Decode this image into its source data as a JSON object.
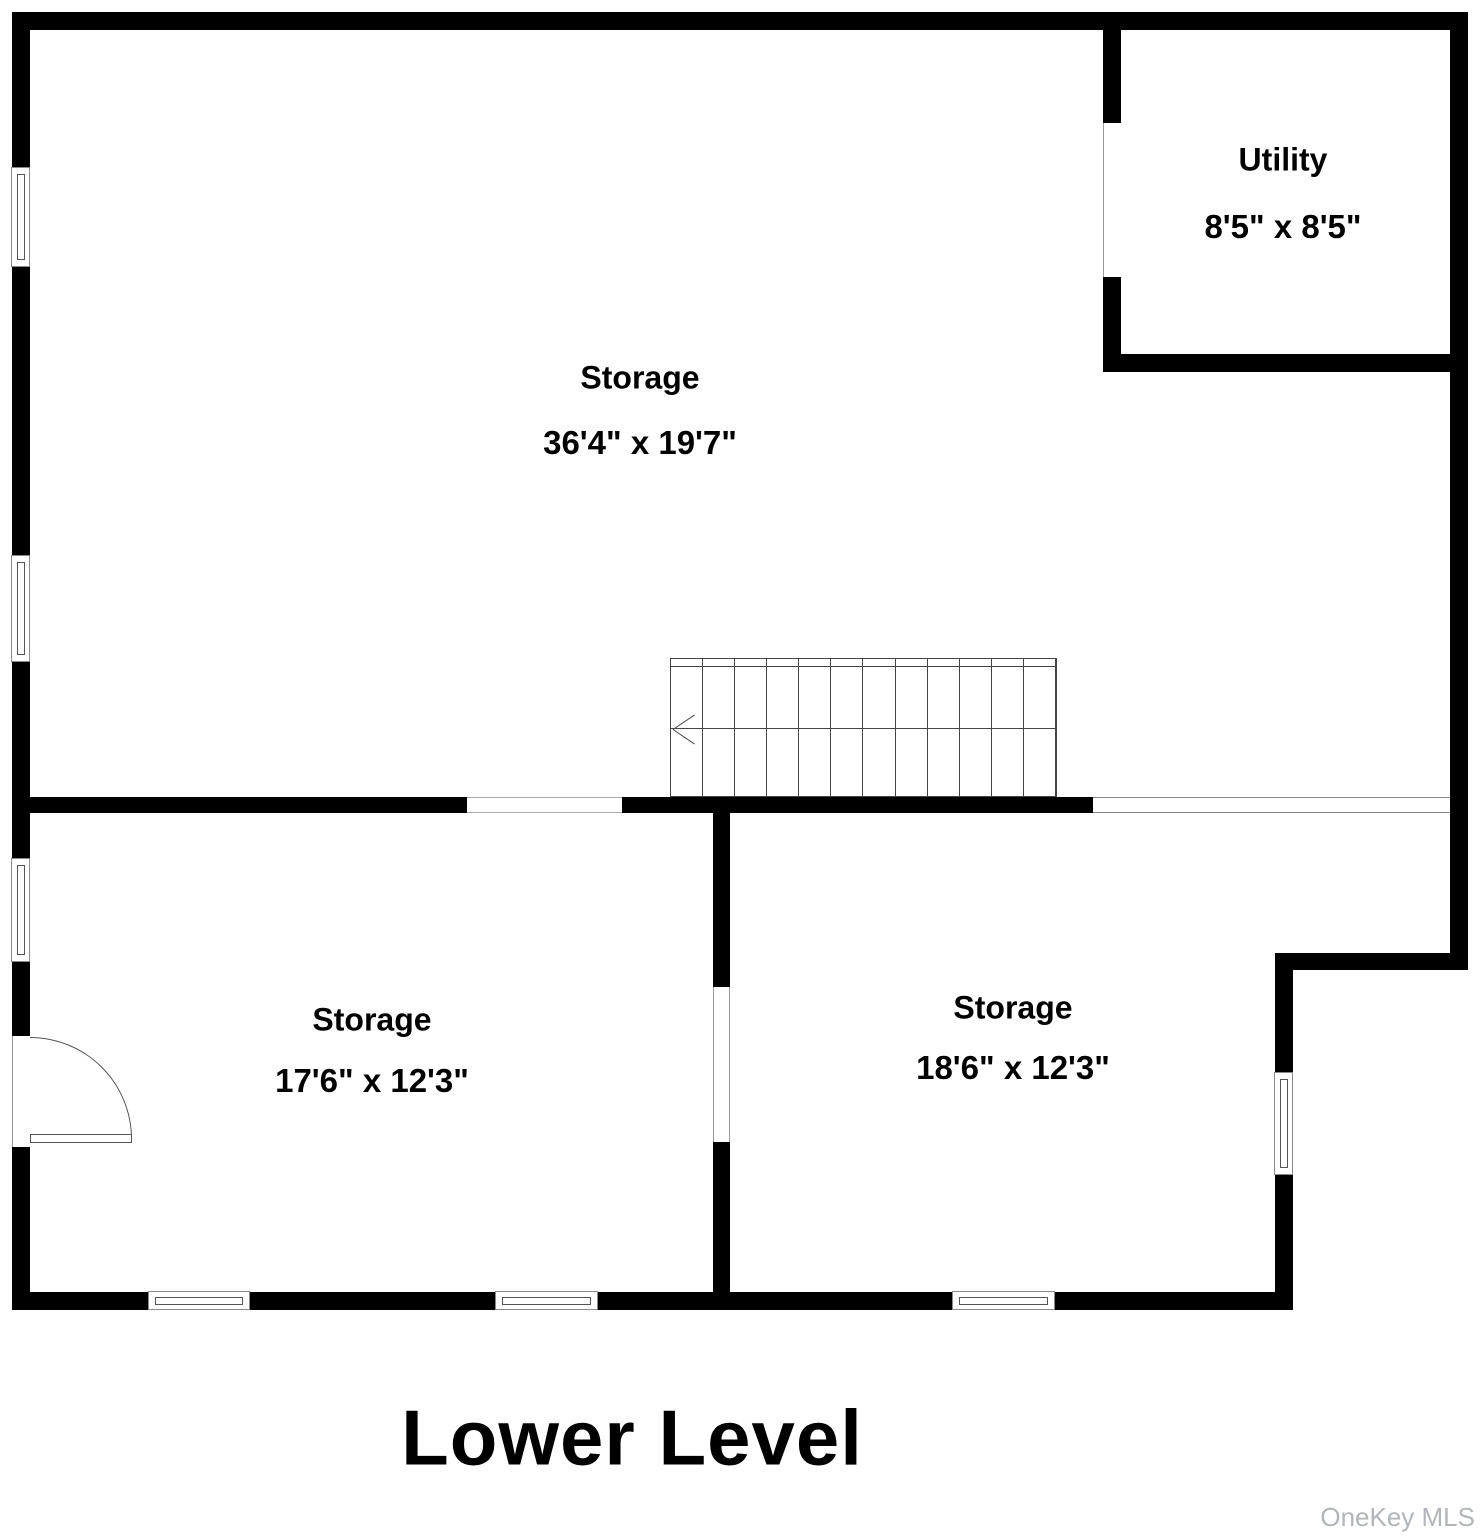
{
  "floorplan": {
    "title": "Lower Level",
    "watermark": "OneKey MLS",
    "rooms": {
      "storage_main": {
        "name": "Storage",
        "dims": "36'4\" x 19'7\""
      },
      "utility": {
        "name": "Utility",
        "dims": "8'5\" x 8'5\""
      },
      "storage_left": {
        "name": "Storage",
        "dims": "17'6\" x 12'3\""
      },
      "storage_right": {
        "name": "Storage",
        "dims": "18'6\" x 12'3\""
      }
    }
  }
}
